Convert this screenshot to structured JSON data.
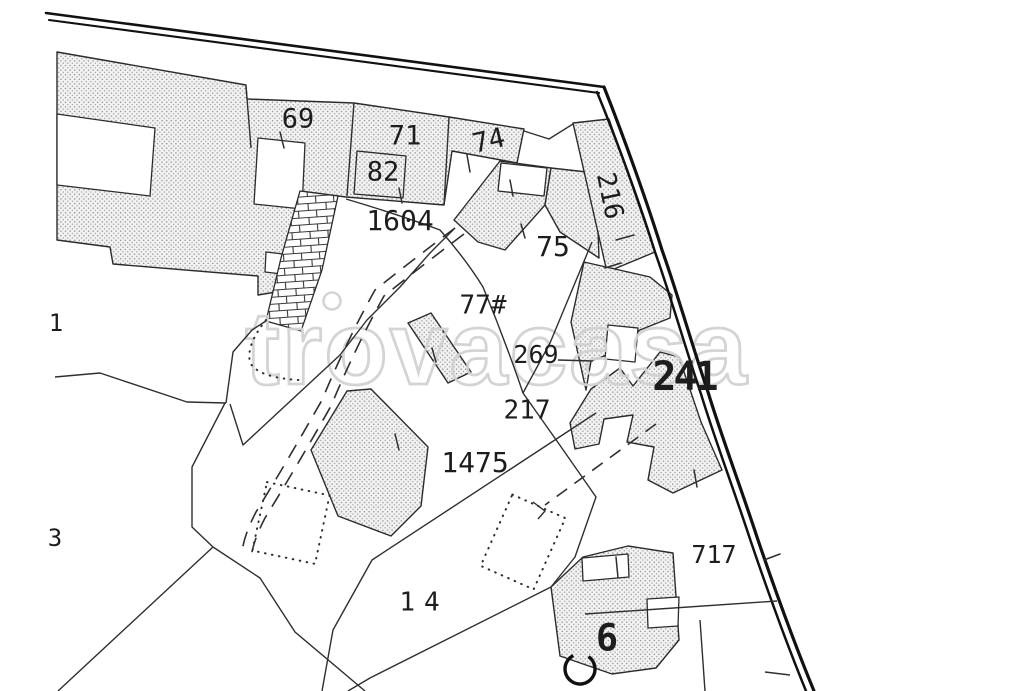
{
  "title": "Cadastral parcel map extract",
  "watermark": {
    "text": "trovacasa",
    "color": "#d2d2d2"
  },
  "colors": {
    "background": "#ffffff",
    "line": "#222222",
    "boundary": "#111111",
    "hatch_dot": "#8f8f8f",
    "hatch_bg": "#f2f2f2"
  },
  "labels": [
    {
      "id": "parcel-69",
      "text": "69"
    },
    {
      "id": "parcel-71",
      "text": "71"
    },
    {
      "id": "parcel-82",
      "text": "82"
    },
    {
      "id": "parcel-74",
      "text": "74"
    },
    {
      "id": "parcel-1604",
      "text": "1604"
    },
    {
      "id": "parcel-75",
      "text": "75"
    },
    {
      "id": "parcel-216",
      "text": "216"
    },
    {
      "id": "parcel-77",
      "text": "77#"
    },
    {
      "id": "parcel-269",
      "text": "269"
    },
    {
      "id": "parcel-217",
      "text": "217"
    },
    {
      "id": "parcel-241",
      "text": "241"
    },
    {
      "id": "parcel-1475",
      "text": "1475"
    },
    {
      "id": "parcel-14",
      "text": "14"
    },
    {
      "id": "parcel-717",
      "text": "717"
    },
    {
      "id": "parcel-6",
      "text": "6"
    },
    {
      "id": "parcel-edge-1",
      "text": "1"
    },
    {
      "id": "parcel-edge-3",
      "text": "3"
    }
  ]
}
